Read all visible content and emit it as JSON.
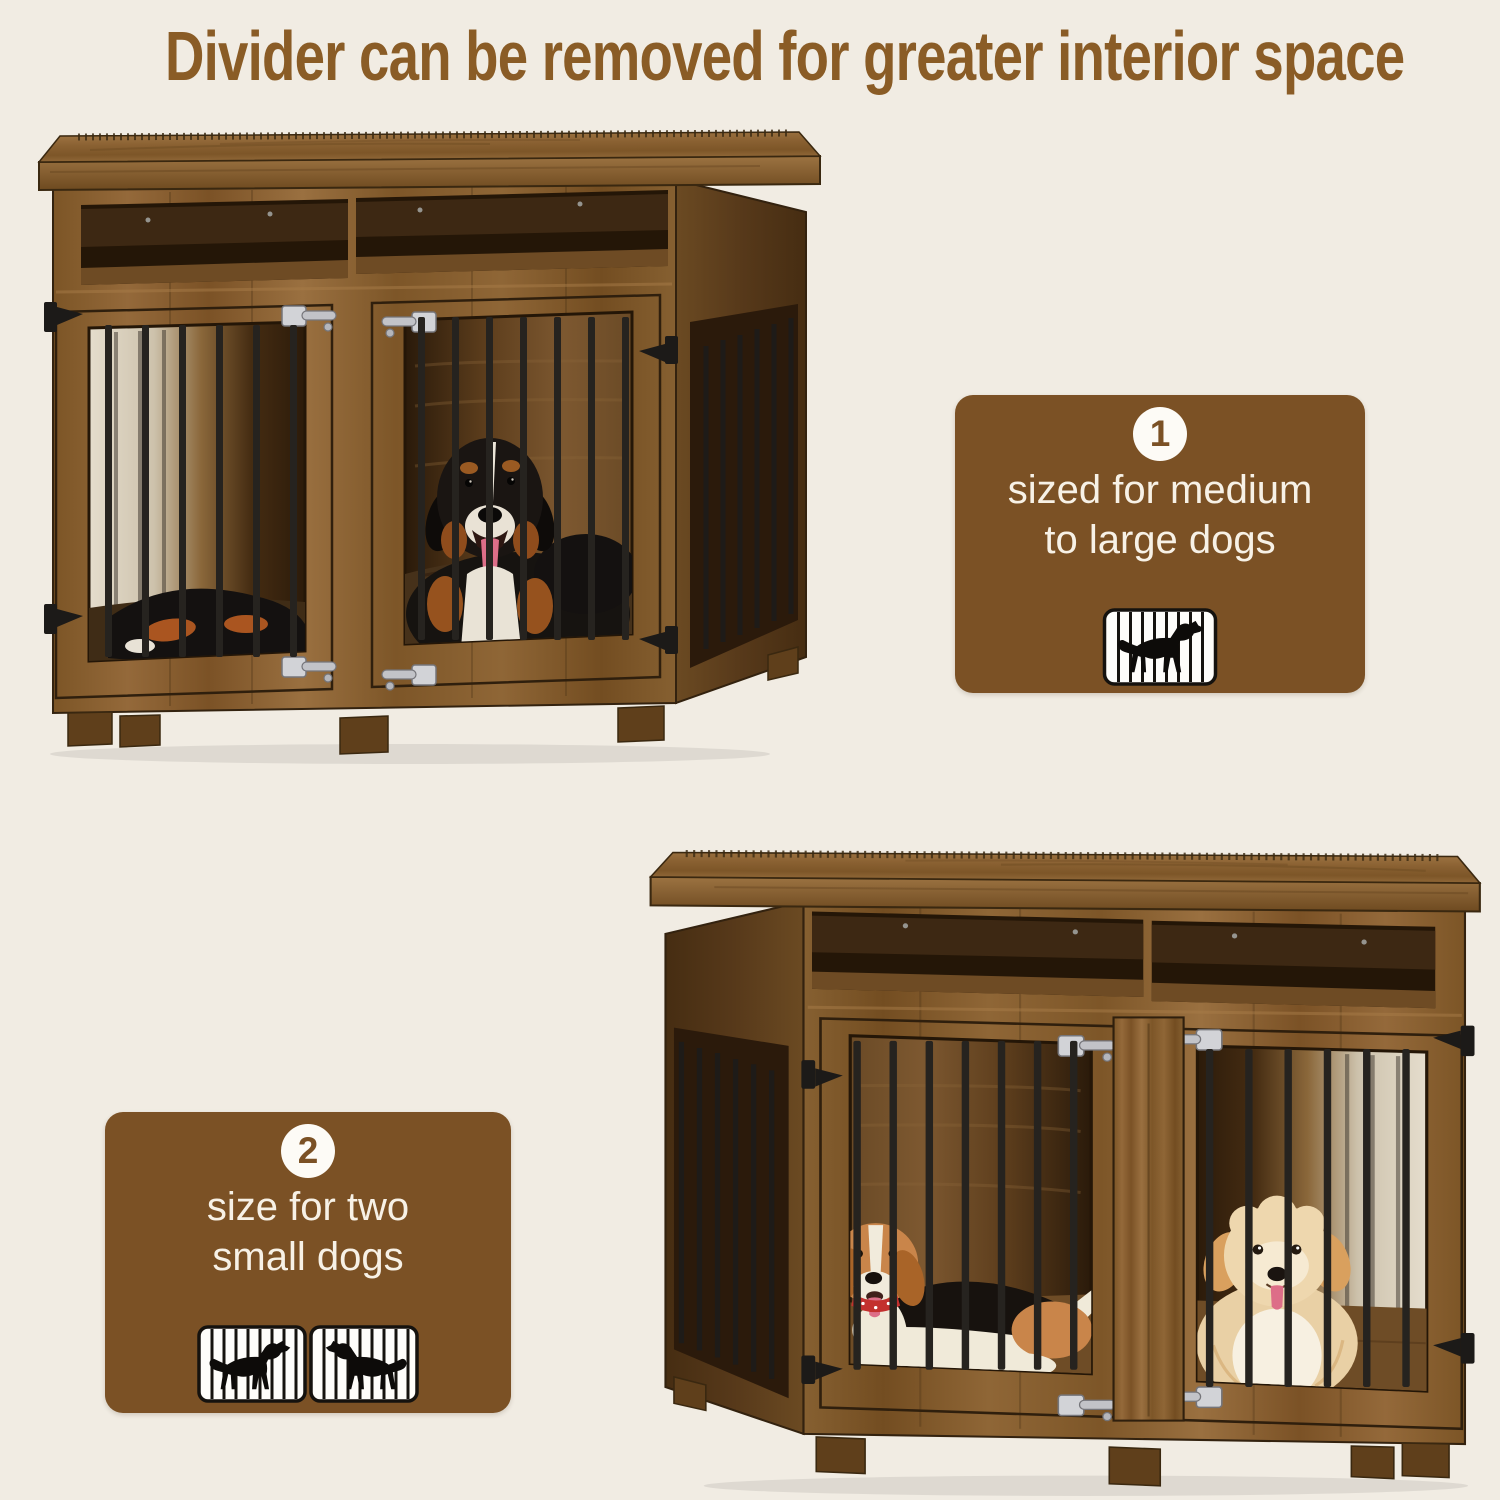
{
  "page": {
    "background_color": "#f1ece3"
  },
  "title": {
    "text": "Divider can be removed for greater interior space",
    "color": "#8a5c26"
  },
  "callouts": [
    {
      "number": "1",
      "lines": [
        "sized for medium",
        "to large dogs"
      ],
      "icon": "dog-in-crate-icon",
      "background_color": "#7b5125",
      "text_color": "#f7f1e6"
    },
    {
      "number": "2",
      "lines": [
        "size for two",
        "small dogs"
      ],
      "icon": "two-dogs-in-crates-icon",
      "background_color": "#7b5125",
      "text_color": "#f7f1e6"
    }
  ],
  "photos": [
    {
      "alt": "Rustic brown wooden dog crate furniture, divider removed, one large Bernese Mountain Dog lying inside behind black metal bars"
    },
    {
      "alt": "Rustic brown wooden dog crate furniture, divider installed, a beagle and a small cream dog in two separate compartments"
    }
  ],
  "colors": {
    "badge_background": "#fdfbf6",
    "badge_number": "#7b5125",
    "wood_light": "#a87c48",
    "wood_mid": "#8a6234",
    "wood_dark": "#5d3f1d",
    "metal_bars": "#26231f",
    "icon_ink": "#15120e"
  }
}
